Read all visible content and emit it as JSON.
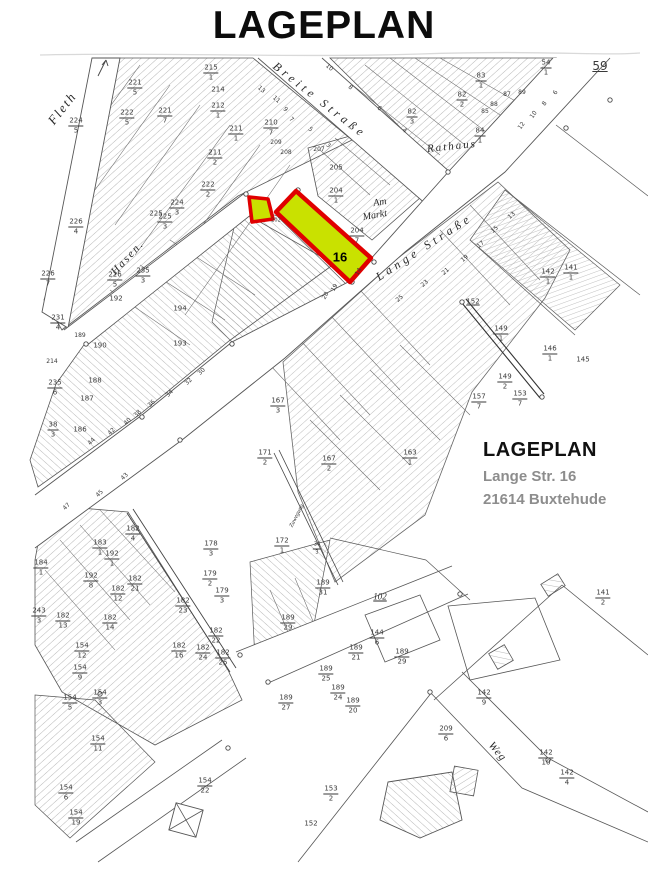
{
  "title": "LAGEPLAN",
  "info_block": {
    "heading": "LAGEPLAN",
    "line1": "Lange Str. 16",
    "line2": "21614 Buxtehude"
  },
  "highlight": {
    "parcel_label": "16",
    "fill": "#c9e100",
    "stroke": "#e00000"
  },
  "map": {
    "labels": [
      {
        "t": "Fleth",
        "x": 62,
        "y": 108,
        "r": -52,
        "s": 13,
        "i": 1,
        "ls": 2,
        "n": "street-label-fleth"
      },
      {
        "t": "Breite Straße",
        "x": 320,
        "y": 100,
        "r": 38,
        "s": 12,
        "i": 1,
        "ls": 4,
        "n": "street-label-breite-strasse"
      },
      {
        "t": "Lange Straße",
        "x": 424,
        "y": 247,
        "r": -33,
        "s": 12,
        "i": 1,
        "ls": 4,
        "n": "street-label-lange-strasse"
      },
      {
        "t": "Hasen.",
        "x": 128,
        "y": 258,
        "r": -47,
        "s": 11,
        "i": 1,
        "ls": 2,
        "n": "street-label-hasen"
      },
      {
        "t": "Am",
        "x": 380,
        "y": 203,
        "r": -10,
        "s": 10,
        "i": 1,
        "n": "street-label-am-markt"
      },
      {
        "t": "Markt",
        "x": 375,
        "y": 216,
        "r": -10,
        "s": 10,
        "i": 1,
        "n": "street-label-am-markt"
      },
      {
        "t": "Rathaus",
        "x": 452,
        "y": 147,
        "r": -6,
        "s": 11,
        "i": 1,
        "ls": 2,
        "n": "street-label-rathaus"
      },
      {
        "t": "Weg",
        "x": 497,
        "y": 752,
        "r": 50,
        "s": 11,
        "i": 1,
        "ls": 1,
        "n": "street-label-weg"
      },
      {
        "t": "Zuwegung",
        "x": 297,
        "y": 516,
        "r": -63,
        "s": 6,
        "i": 1,
        "n": "street-label-lane"
      },
      {
        "t": "59",
        "x": 600,
        "y": 66,
        "s": 12,
        "u": 1,
        "n": "sheet-number"
      },
      {
        "t": "102",
        "x": 380,
        "y": 597,
        "s": 9,
        "u": 1,
        "i": 1
      },
      {
        "t": "224",
        "d": "5",
        "x": 76,
        "y": 126
      },
      {
        "t": "221",
        "d": "5",
        "x": 135,
        "y": 88
      },
      {
        "t": "222",
        "d": "5",
        "x": 127,
        "y": 118
      },
      {
        "t": "221",
        "d": "7",
        "x": 165,
        "y": 116
      },
      {
        "t": "215",
        "d": "1",
        "x": 211,
        "y": 73
      },
      {
        "t": "214",
        "x": 218,
        "y": 90
      },
      {
        "t": "212",
        "d": "1",
        "x": 218,
        "y": 111
      },
      {
        "t": "211",
        "d": "1",
        "x": 236,
        "y": 134
      },
      {
        "t": "211",
        "d": "2",
        "x": 215,
        "y": 158
      },
      {
        "t": "222",
        "d": "2",
        "x": 208,
        "y": 190
      },
      {
        "t": "224",
        "d": "3",
        "x": 177,
        "y": 208
      },
      {
        "t": "225",
        "x": 156,
        "y": 214
      },
      {
        "t": "210",
        "d": "7",
        "x": 271,
        "y": 128
      },
      {
        "t": "209",
        "x": 276,
        "y": 143,
        "s": 6
      },
      {
        "t": "208",
        "x": 286,
        "y": 153,
        "s": 6
      },
      {
        "t": "207",
        "x": 319,
        "y": 150,
        "s": 6
      },
      {
        "t": "13",
        "x": 261,
        "y": 90,
        "r": 40,
        "s": 6
      },
      {
        "t": "11",
        "x": 276,
        "y": 100,
        "r": 40,
        "s": 6
      },
      {
        "t": "9",
        "x": 285,
        "y": 110,
        "r": 40,
        "s": 6
      },
      {
        "t": "7",
        "x": 291,
        "y": 120,
        "r": 40,
        "s": 6
      },
      {
        "t": "5",
        "x": 310,
        "y": 130,
        "r": 40,
        "s": 6
      },
      {
        "t": "3",
        "x": 328,
        "y": 146,
        "r": 40,
        "s": 6
      },
      {
        "t": "10",
        "x": 329,
        "y": 68,
        "r": 40,
        "s": 6
      },
      {
        "t": "8",
        "x": 350,
        "y": 88,
        "r": 40,
        "s": 6
      },
      {
        "t": "6",
        "x": 379,
        "y": 109,
        "r": 40,
        "s": 6
      },
      {
        "t": "4",
        "x": 404,
        "y": 131,
        "r": 40,
        "s": 6
      },
      {
        "t": "82",
        "d": "3",
        "x": 412,
        "y": 117
      },
      {
        "t": "54",
        "d": "1",
        "x": 546,
        "y": 68
      },
      {
        "t": "83",
        "d": "1",
        "x": 481,
        "y": 81
      },
      {
        "t": "82",
        "d": "2",
        "x": 462,
        "y": 100
      },
      {
        "t": "87",
        "x": 507,
        "y": 95,
        "s": 6
      },
      {
        "t": "88",
        "x": 494,
        "y": 105,
        "s": 6
      },
      {
        "t": "89",
        "x": 522,
        "y": 93,
        "s": 6
      },
      {
        "t": "85",
        "x": 485,
        "y": 112,
        "s": 6
      },
      {
        "t": "84",
        "d": "1",
        "x": 480,
        "y": 136
      },
      {
        "t": "12",
        "x": 522,
        "y": 126,
        "r": -55,
        "s": 6
      },
      {
        "t": "10",
        "x": 534,
        "y": 115,
        "r": -55,
        "s": 6
      },
      {
        "t": "8",
        "x": 545,
        "y": 104,
        "r": -55,
        "s": 6
      },
      {
        "t": "6",
        "x": 556,
        "y": 93,
        "r": -55,
        "s": 6
      },
      {
        "t": "205",
        "x": 336,
        "y": 168
      },
      {
        "t": "204",
        "d": "1",
        "x": 336,
        "y": 196
      },
      {
        "t": "204",
        "d": "7",
        "x": 357,
        "y": 236
      },
      {
        "t": "202",
        "x": 276,
        "y": 221,
        "s": 5
      },
      {
        "t": "19",
        "x": 335,
        "y": 288,
        "r": -60,
        "s": 6
      },
      {
        "t": "20",
        "x": 326,
        "y": 296,
        "r": -60,
        "s": 6
      },
      {
        "t": "14",
        "x": 359,
        "y": 272,
        "r": -60,
        "s": 6
      },
      {
        "t": "142",
        "d": "1",
        "x": 548,
        "y": 277
      },
      {
        "t": "141",
        "d": "1",
        "x": 571,
        "y": 273
      },
      {
        "t": "152",
        "x": 473,
        "y": 302,
        "u": 1
      },
      {
        "t": "149",
        "d": "1",
        "x": 501,
        "y": 334
      },
      {
        "t": "146",
        "d": "1",
        "x": 550,
        "y": 354
      },
      {
        "t": "145",
        "x": 583,
        "y": 360
      },
      {
        "t": "149",
        "d": "2",
        "x": 505,
        "y": 382
      },
      {
        "t": "153",
        "d": "7",
        "x": 520,
        "y": 399
      },
      {
        "t": "157",
        "d": "7",
        "x": 479,
        "y": 402
      },
      {
        "t": "13",
        "x": 512,
        "y": 216,
        "r": -40,
        "s": 6
      },
      {
        "t": "15",
        "x": 495,
        "y": 230,
        "r": -40,
        "s": 6
      },
      {
        "t": "17",
        "x": 481,
        "y": 245,
        "r": -40,
        "s": 6
      },
      {
        "t": "19",
        "x": 465,
        "y": 259,
        "r": -40,
        "s": 6
      },
      {
        "t": "21",
        "x": 446,
        "y": 272,
        "r": -40,
        "s": 6
      },
      {
        "t": "23",
        "x": 425,
        "y": 284,
        "r": -40,
        "s": 6
      },
      {
        "t": "25",
        "x": 400,
        "y": 299,
        "r": -40,
        "s": 6
      },
      {
        "t": "226",
        "d": "4",
        "x": 76,
        "y": 227
      },
      {
        "t": "225",
        "d": "3",
        "x": 165,
        "y": 222
      },
      {
        "t": "235",
        "d": "3",
        "x": 143,
        "y": 276
      },
      {
        "t": "226",
        "d": "7",
        "x": 48,
        "y": 279
      },
      {
        "t": "226",
        "d": "5",
        "x": 115,
        "y": 280
      },
      {
        "t": "192",
        "x": 116,
        "y": 299
      },
      {
        "t": "194",
        "x": 180,
        "y": 309
      },
      {
        "t": "193",
        "x": 180,
        "y": 344
      },
      {
        "t": "189",
        "x": 80,
        "y": 336,
        "s": 6
      },
      {
        "t": "190",
        "x": 100,
        "y": 346
      },
      {
        "t": "231",
        "d": "4",
        "x": 58,
        "y": 323
      },
      {
        "t": "214",
        "x": 52,
        "y": 362,
        "s": 6
      },
      {
        "t": "235",
        "d": "6",
        "x": 55,
        "y": 388
      },
      {
        "t": "188",
        "x": 95,
        "y": 381
      },
      {
        "t": "187",
        "x": 87,
        "y": 399
      },
      {
        "t": "186",
        "x": 80,
        "y": 430
      },
      {
        "t": "38",
        "d": "3",
        "x": 53,
        "y": 430
      },
      {
        "t": "30",
        "x": 202,
        "y": 372,
        "r": -45,
        "s": 6
      },
      {
        "t": "32",
        "x": 189,
        "y": 382,
        "r": -45,
        "s": 6
      },
      {
        "t": "34",
        "x": 170,
        "y": 394,
        "r": -45,
        "s": 6
      },
      {
        "t": "36",
        "x": 152,
        "y": 404,
        "r": -45,
        "s": 6
      },
      {
        "t": "38",
        "x": 138,
        "y": 414,
        "r": -45,
        "s": 6
      },
      {
        "t": "40",
        "x": 128,
        "y": 422,
        "r": -45,
        "s": 6
      },
      {
        "t": "42",
        "x": 112,
        "y": 432,
        "r": -45,
        "s": 6
      },
      {
        "t": "44",
        "x": 92,
        "y": 442,
        "r": -45,
        "s": 6
      },
      {
        "t": "43",
        "x": 125,
        "y": 477,
        "r": -45,
        "s": 6
      },
      {
        "t": "45",
        "x": 100,
        "y": 494,
        "r": -45,
        "s": 6
      },
      {
        "t": "47",
        "x": 67,
        "y": 507,
        "r": -45,
        "s": 6
      },
      {
        "t": "167",
        "d": "3",
        "x": 278,
        "y": 406
      },
      {
        "t": "171",
        "d": "2",
        "x": 265,
        "y": 458
      },
      {
        "t": "167",
        "d": "2",
        "x": 329,
        "y": 464
      },
      {
        "t": "163",
        "d": "1",
        "x": 410,
        "y": 458
      },
      {
        "t": "172",
        "d": "1",
        "x": 282,
        "y": 546
      },
      {
        "t": "34",
        "d": "3",
        "x": 317,
        "y": 549,
        "s": 5
      },
      {
        "t": "182",
        "d": "4",
        "x": 133,
        "y": 534
      },
      {
        "t": "183",
        "d": "1",
        "x": 100,
        "y": 548
      },
      {
        "t": "192",
        "d": "1",
        "x": 112,
        "y": 559
      },
      {
        "t": "192",
        "d": "8",
        "x": 91,
        "y": 581
      },
      {
        "t": "182",
        "d": "21",
        "x": 135,
        "y": 584
      },
      {
        "t": "182",
        "d": "12",
        "x": 118,
        "y": 594
      },
      {
        "t": "182",
        "d": "13",
        "x": 63,
        "y": 621
      },
      {
        "t": "182",
        "d": "14",
        "x": 110,
        "y": 623
      },
      {
        "t": "182",
        "d": "23",
        "x": 183,
        "y": 606
      },
      {
        "t": "182",
        "d": "22",
        "x": 216,
        "y": 636
      },
      {
        "t": "182",
        "d": "16",
        "x": 179,
        "y": 651
      },
      {
        "t": "182",
        "d": "24",
        "x": 203,
        "y": 653
      },
      {
        "t": "182",
        "d": "25",
        "x": 223,
        "y": 658
      },
      {
        "t": "178",
        "d": "3",
        "x": 211,
        "y": 549
      },
      {
        "t": "179",
        "d": "2",
        "x": 210,
        "y": 579
      },
      {
        "t": "179",
        "d": "3",
        "x": 222,
        "y": 596
      },
      {
        "t": "184",
        "d": "1",
        "x": 41,
        "y": 568
      },
      {
        "t": "243",
        "d": "3",
        "x": 39,
        "y": 616
      },
      {
        "t": "154",
        "d": "12",
        "x": 82,
        "y": 651
      },
      {
        "t": "154",
        "d": "9",
        "x": 80,
        "y": 673
      },
      {
        "t": "189",
        "d": "31",
        "x": 323,
        "y": 588
      },
      {
        "t": "189",
        "d": "29",
        "x": 288,
        "y": 623
      },
      {
        "t": "144",
        "d": "6",
        "x": 377,
        "y": 638
      },
      {
        "t": "189",
        "d": "21",
        "x": 356,
        "y": 653
      },
      {
        "t": "189",
        "d": "29",
        "x": 402,
        "y": 657
      },
      {
        "t": "189",
        "d": "25",
        "x": 326,
        "y": 674
      },
      {
        "t": "189",
        "d": "24",
        "x": 338,
        "y": 693
      },
      {
        "t": "189",
        "d": "20",
        "x": 353,
        "y": 706
      },
      {
        "t": "189",
        "d": "27",
        "x": 286,
        "y": 703
      },
      {
        "t": "209",
        "d": "6",
        "x": 446,
        "y": 734
      },
      {
        "t": "141",
        "d": "2",
        "x": 603,
        "y": 598
      },
      {
        "t": "142",
        "d": "9",
        "x": 484,
        "y": 698
      },
      {
        "t": "142",
        "d": "10",
        "x": 546,
        "y": 758
      },
      {
        "t": "142",
        "d": "4",
        "x": 567,
        "y": 778
      },
      {
        "t": "154",
        "d": "5",
        "x": 70,
        "y": 703
      },
      {
        "t": "154",
        "d": "3",
        "x": 100,
        "y": 698
      },
      {
        "t": "154",
        "d": "11",
        "x": 98,
        "y": 744
      },
      {
        "t": "154",
        "d": "6",
        "x": 66,
        "y": 793
      },
      {
        "t": "154",
        "d": "19",
        "x": 76,
        "y": 818
      },
      {
        "t": "154",
        "d": "22",
        "x": 205,
        "y": 786
      },
      {
        "t": "153",
        "d": "2",
        "x": 331,
        "y": 794
      },
      {
        "t": "152",
        "x": 311,
        "y": 824
      }
    ]
  }
}
